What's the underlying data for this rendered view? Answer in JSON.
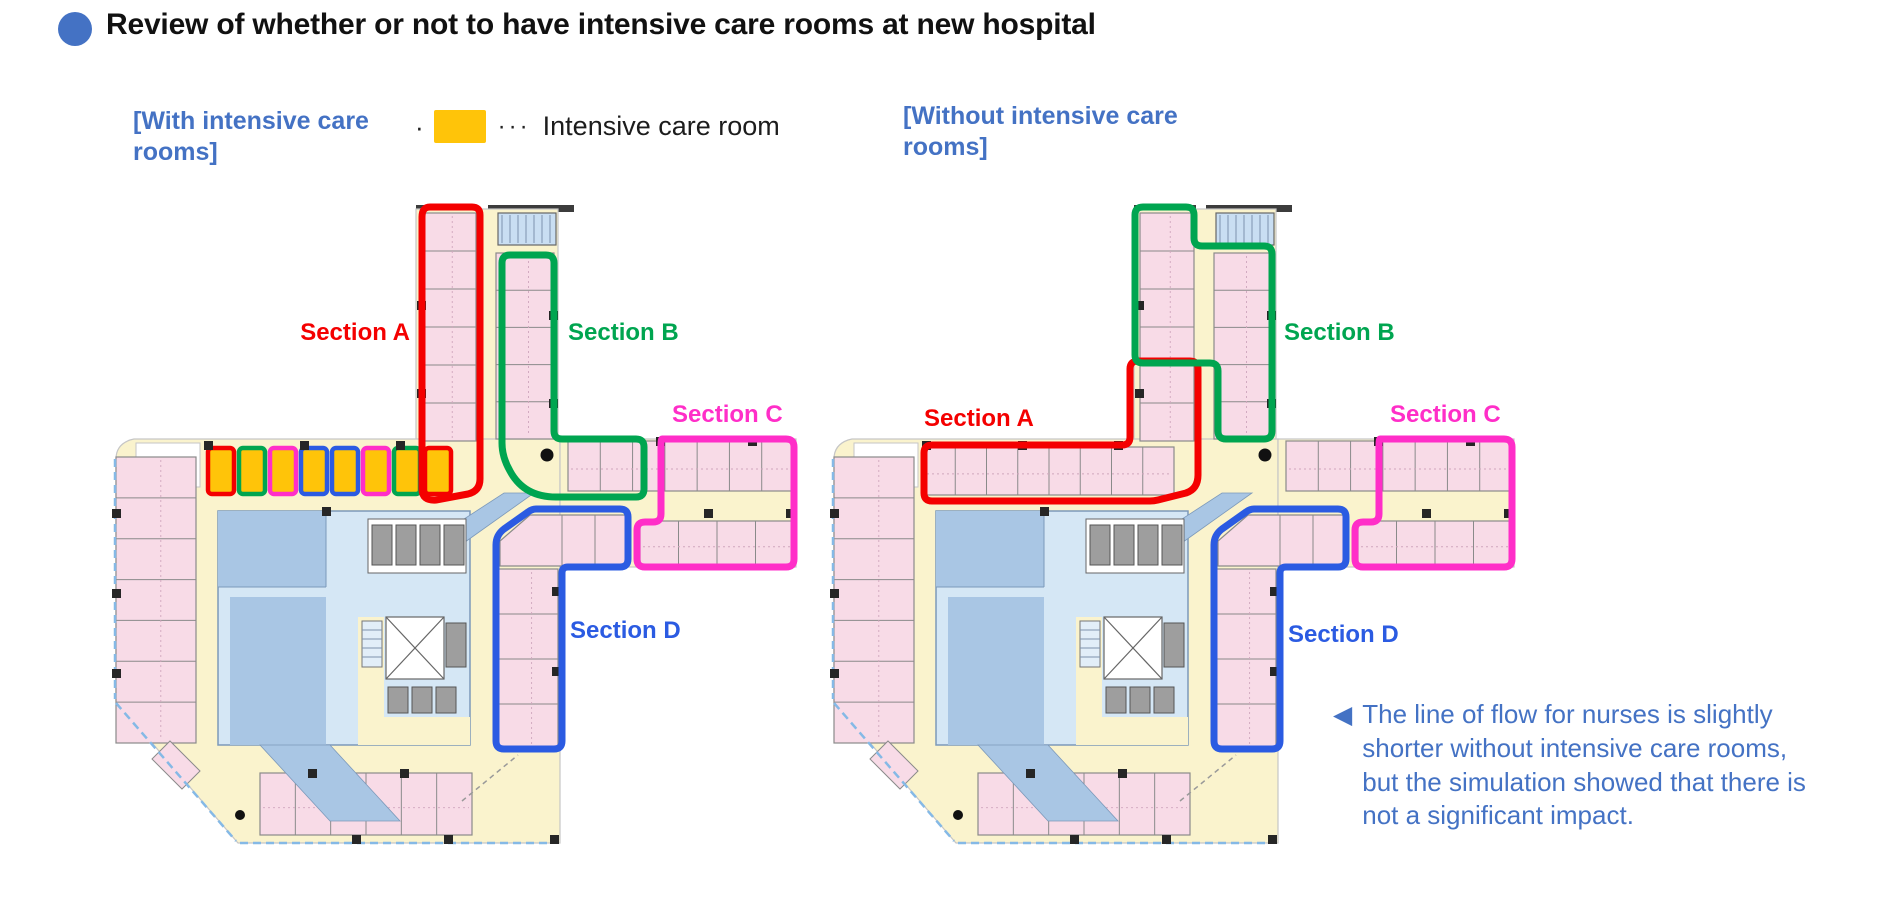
{
  "slide_title": "Review of whether or not to have intensive care rooms at new hospital",
  "legend": {
    "bullet": "·",
    "dots": "···",
    "label": "Intensive care room",
    "swatch_color": "#FFC409"
  },
  "sections": [
    {
      "id": "a",
      "label": "Section A",
      "color": "#F40000"
    },
    {
      "id": "b",
      "label": "Section B",
      "color": "#00A550"
    },
    {
      "id": "c",
      "label": "Section C",
      "color": "#FF2EC8"
    },
    {
      "id": "d",
      "label": "Section D",
      "color": "#2B5BE2"
    }
  ],
  "plans": [
    {
      "id": "with-icu",
      "caption": "[With intensive care rooms]",
      "has_intensive_care_rooms": true,
      "icu_room_count": 8,
      "icu_border_colors": [
        "#F40000",
        "#00A550",
        "#FF2EC8",
        "#2B5BE2",
        "#2B5BE2",
        "#FF2EC8",
        "#00A550",
        "#F40000"
      ]
    },
    {
      "id": "without-icu",
      "caption": "[Without intensive care rooms]",
      "has_intensive_care_rooms": false
    }
  ],
  "note": {
    "arrow": "◀",
    "text": "The line of flow for nurses is slightly shorter without intensive care rooms, but the simulation showed that there is not a significant impact."
  },
  "colors": {
    "accent_blue": "#4472C4",
    "title_text": "#111111",
    "icu_yellow": "#FFC409",
    "room_pink": "#F8DBE7",
    "corridor_yellow": "#FAF3CD",
    "core_blue": "#A9C6E4",
    "core_light": "#D5E7F5",
    "stair_blue": "#C9DEF2",
    "wall_dark": "#3C3C3C",
    "exterior_blue_dash": "#85B9E6"
  }
}
